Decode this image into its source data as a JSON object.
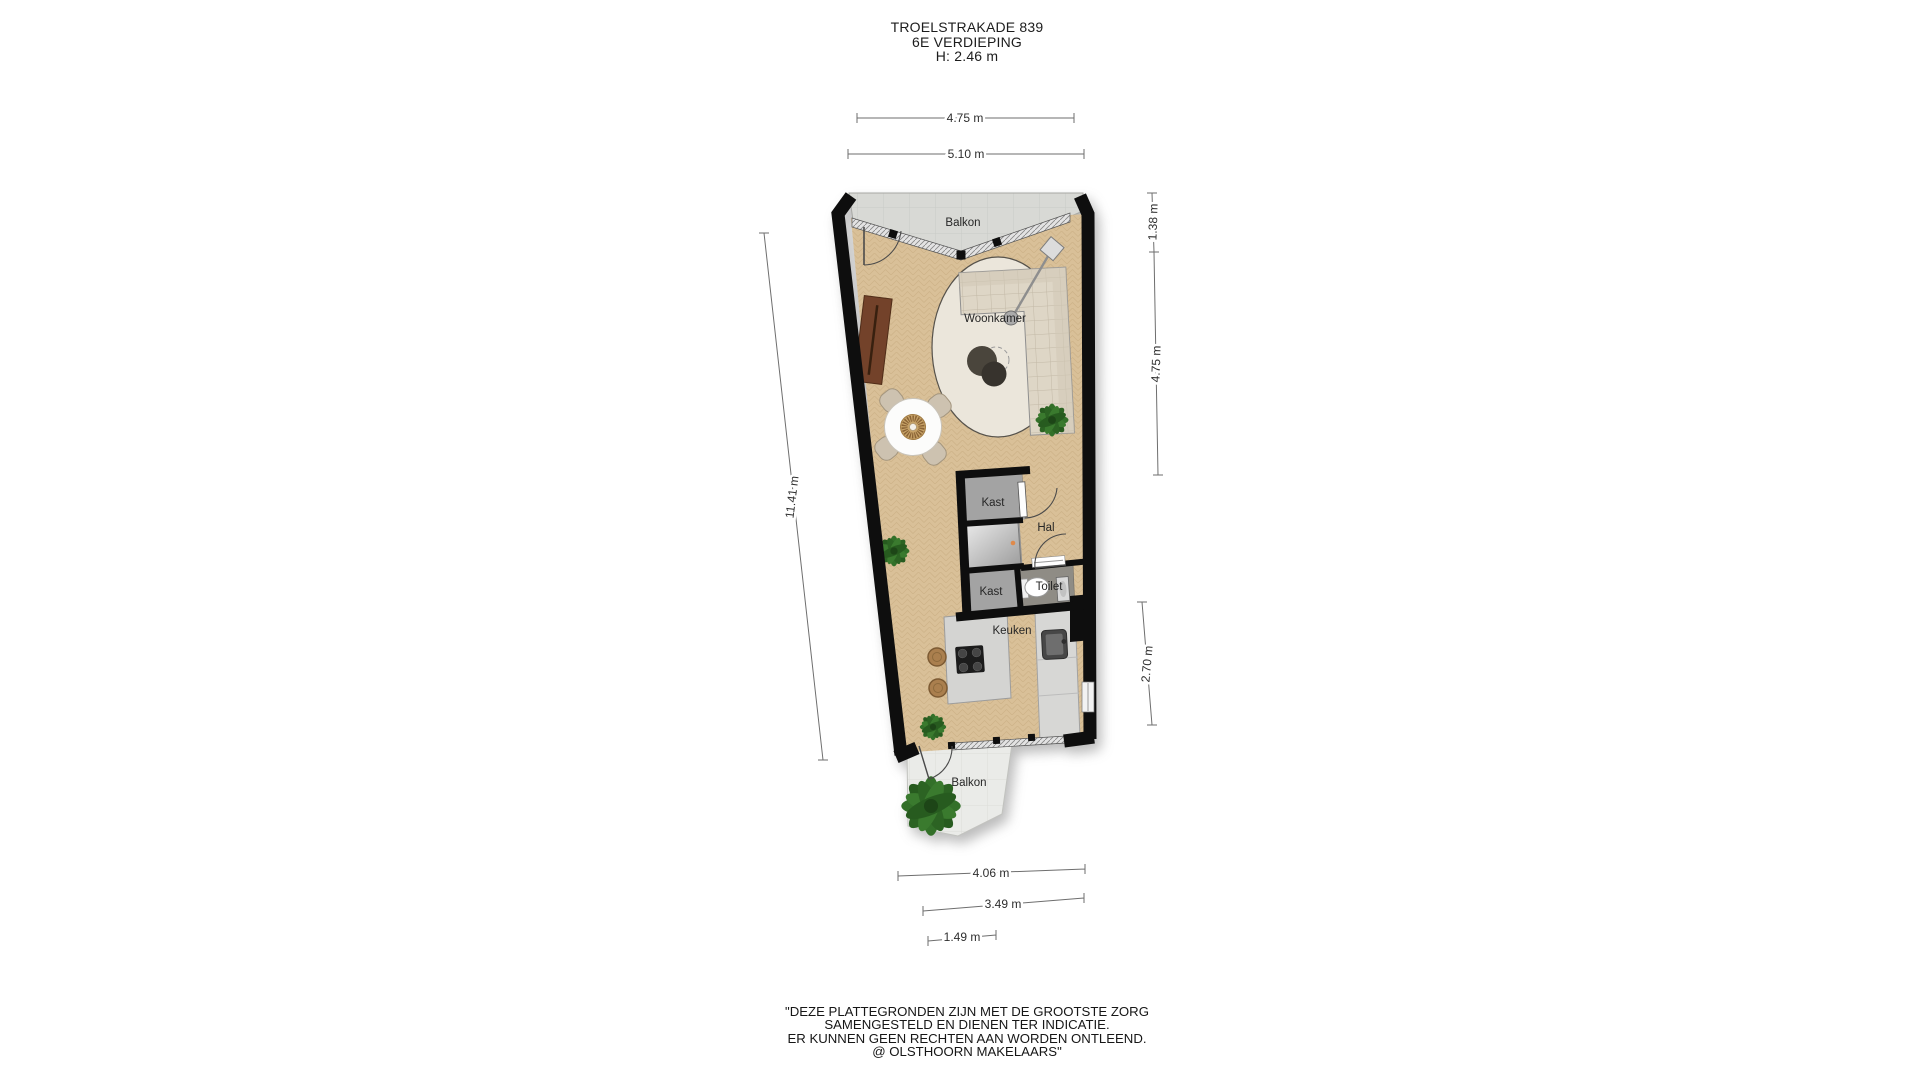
{
  "title": {
    "address": "TROELSTRAKADE 839",
    "floor": "6E VERDIEPING",
    "height": "H: 2.46 m"
  },
  "floorplan": {
    "rooms": {
      "balkon_top": "Balkon",
      "woonkamer": "Woonkamer",
      "kast_1": "Kast",
      "hal": "Hal",
      "kast_2": "Kast",
      "toilet": "Toilet",
      "keuken": "Keuken",
      "balkon_bottom": "Balkon"
    },
    "dimensions": {
      "top_inner": "4.75 m",
      "top_outer": "5.10 m",
      "right_top": "1.38 m",
      "right_middle": "4.75 m",
      "right_bottom": "2.70 m",
      "left_total": "11.41 m",
      "bottom_outer": "4.06 m",
      "bottom_middle": "3.49 m",
      "bottom_inner": "1.49 m"
    },
    "colors": {
      "wall": "#0e0e0e",
      "wood_floor": "#d9c098",
      "closet_floor": "#a3a3a3",
      "toilet_floor": "#8f8c85",
      "balcony_top": "#d8d9d5",
      "balcony_bottom": "#eaebe8",
      "sofa": "#dcd4c3",
      "plant": "#2f6b27",
      "accent_dot": "#df8a4b"
    }
  },
  "disclaimer": {
    "line1": "\"DEZE PLATTEGRONDEN ZIJN MET DE GROOTSTE ZORG",
    "line2": "SAMENGESTELD EN DIENEN TER INDICATIE.",
    "line3": "ER KUNNEN GEEN RECHTEN AAN WORDEN ONTLEEND.",
    "line4": "@ OLSTHOORN MAKELAARS\""
  }
}
